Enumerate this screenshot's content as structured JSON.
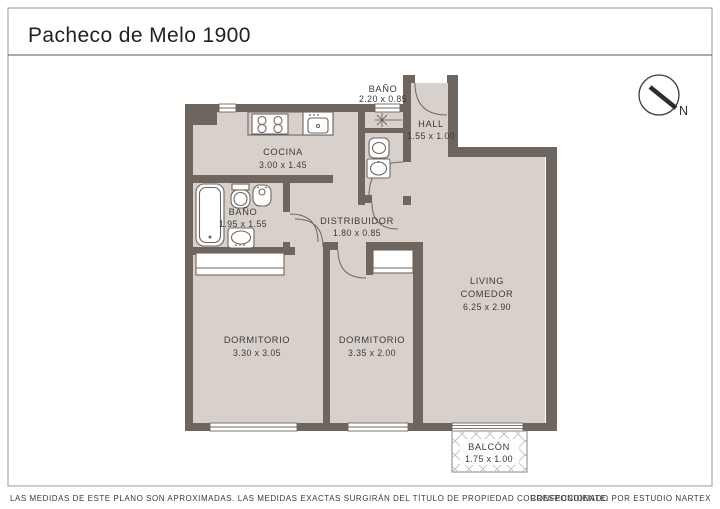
{
  "header": {
    "title": "Pacheco de Melo 1900"
  },
  "compass": {
    "label": "N"
  },
  "rooms": {
    "bano_top": {
      "name": "BAÑO",
      "dims": "2.20 x 0.85"
    },
    "hall": {
      "name": "HALL",
      "dims": "1.55 x 1.00"
    },
    "cocina": {
      "name": "COCINA",
      "dims": "3.00 x 1.45"
    },
    "bano_main": {
      "name": "BAÑO",
      "dims": "1.95 x 1.55"
    },
    "distribuidor": {
      "name": "DISTRIBUIDOR",
      "dims": "1.80 x 0.85"
    },
    "living": {
      "name_line1": "LIVING",
      "name_line2": "COMEDOR",
      "dims": "6.25 x 2.90"
    },
    "dormitorio_1": {
      "name": "DORMITORIO",
      "dims": "3.30 x 3.05"
    },
    "dormitorio_2": {
      "name": "DORMITORIO",
      "dims": "3.35 x 2.00"
    },
    "balcon": {
      "name": "BALCÓN",
      "dims": "1.75 x 1.00"
    }
  },
  "footer": {
    "disclaimer": "LAS MEDIDAS DE ESTE PLANO SON APROXIMADAS. LAS MEDIDAS EXACTAS SURGIRÁN DEL TÍTULO DE PROPIEDAD CORRESPONDIENTE.",
    "credit": "CONFECCIONADO POR ESTUDIO NARTEX"
  },
  "colors": {
    "wall": "#6e655f",
    "floor": "#d8d1cb",
    "hatch": "#c3bbb4"
  }
}
